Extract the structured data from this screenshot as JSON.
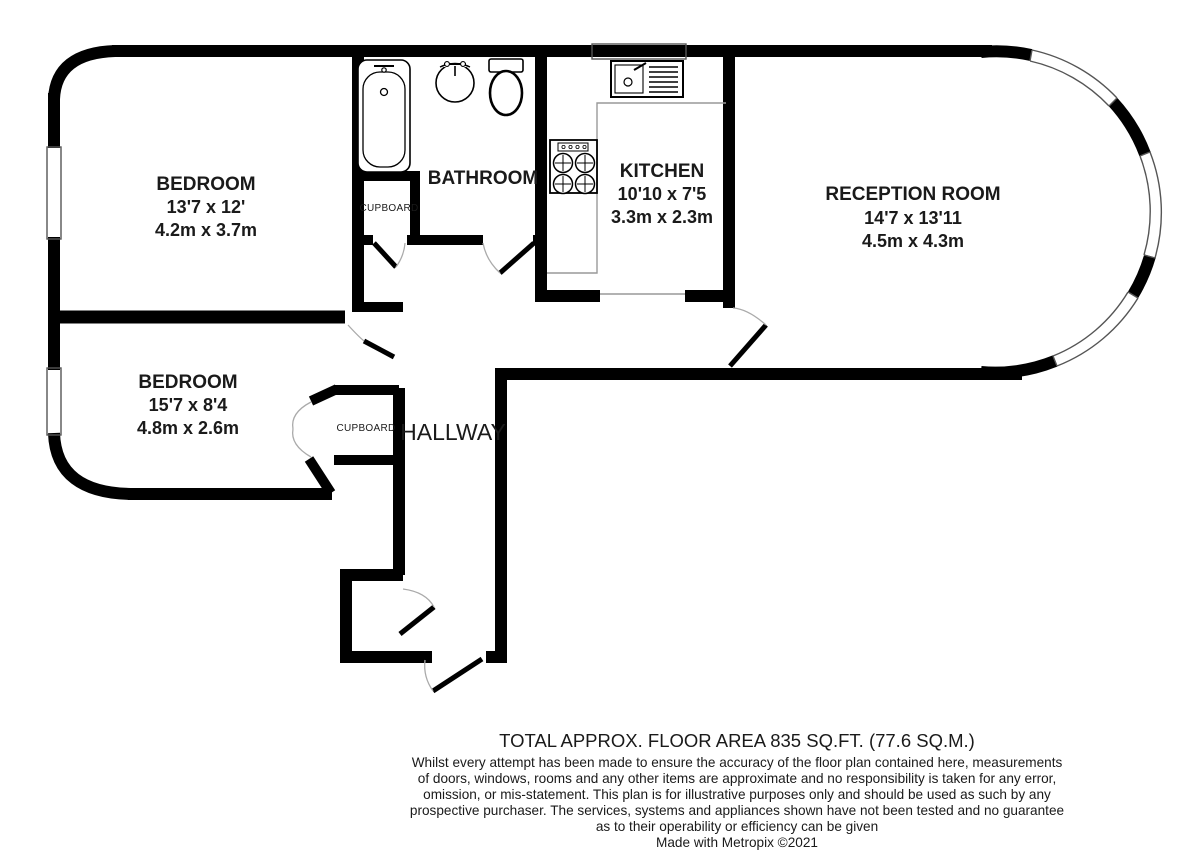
{
  "floorplan": {
    "rooms": [
      {
        "id": "bedroom-1",
        "name": "BEDROOM",
        "dim_imperial": "13'7 x 12'",
        "dim_metric": "4.2m x 3.7m"
      },
      {
        "id": "bathroom",
        "name": "BATHROOM"
      },
      {
        "id": "kitchen",
        "name": "KITCHEN",
        "dim_imperial": "10'10 x 7'5",
        "dim_metric": "3.3m x 2.3m"
      },
      {
        "id": "reception-room",
        "name": "RECEPTION ROOM",
        "dim_imperial": "14'7 x 13'11",
        "dim_metric": "4.5m x 4.3m"
      },
      {
        "id": "bedroom-2",
        "name": "BEDROOM",
        "dim_imperial": "15'7 x 8'4",
        "dim_metric": "4.8m x 2.6m"
      },
      {
        "id": "hallway",
        "name": "HALLWAY"
      }
    ],
    "cupboards": {
      "bathroom_cupboard": "CUPBOARD",
      "bedroom_cupboard": "CUPBOARD"
    },
    "fixtures": [
      "bathtub",
      "washbasin",
      "toilet",
      "kitchen-sink",
      "hob"
    ],
    "colors": {
      "wall": "#000000",
      "background": "#ffffff",
      "door_arc": "#aaaaaa",
      "counter_line": "#999999"
    }
  },
  "footer": {
    "total_area": "TOTAL APPROX. FLOOR AREA 835 SQ.FT. (77.6 SQ.M.)",
    "disclaimer_lines": [
      "Whilst every attempt has been made to ensure the accuracy of the floor plan contained here, measurements",
      "of doors, windows, rooms and any other items are approximate and no responsibility is taken for any error,",
      "omission, or mis-statement. This plan is for illustrative purposes only and should be used as such by any",
      "prospective purchaser. The services, systems and appliances shown have not been tested and no guarantee",
      "as to their operability or efficiency can be given"
    ],
    "credit": "Made with Metropix ©2021"
  }
}
